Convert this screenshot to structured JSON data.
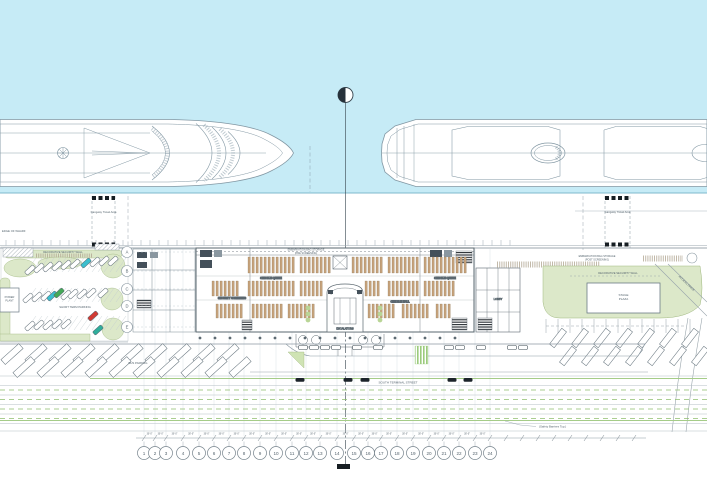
{
  "drawing": {
    "water_color": "#c6ebf6",
    "water_edge_color": "#7fb9cc",
    "landscape_color": "#dce8c9",
    "landscape_edge_color": "#9fb87f",
    "queue_color": "#c5a27b",
    "lane_color": "#8fbf6f",
    "car_accent_colors": [
      "#3bbfce",
      "#44a957",
      "#d23a33",
      "#2fae9b"
    ]
  },
  "labels": {
    "edge_of_wharf": "EDGE OF WHARF",
    "gangway": "Gangway Travel Area",
    "security_wall_left": "DECORATIVE SECURITY WALL",
    "security_wall_right": "DECORATIVE SECURITY WALL",
    "storage_pre_1": "EMBARKATION BAG STORAGE",
    "storage_pre_2": "(PRE SCREENING)",
    "storage_post_1": "EMBARKATION BAG STORAGE",
    "storage_post_2": "(POST SCREENING)",
    "short_term_parking": "SHORT TERM PARKING",
    "bus_parking": "BUS PARKING",
    "street": "SOUTH TERMINAL STREET",
    "safety_barriers": "(Safety Barriers Typ.)",
    "access_drive": "ACCESS DRIVE",
    "plaza_left_1": "POWER",
    "plaza_left_2": "PLANT",
    "plaza_right_1": "STAGE",
    "plaza_right_2": "PLAZA",
    "security_screening": "SECURITY SCREENING",
    "checkin_queue_w": "CHECK-IN QUEUE",
    "checkin_queue_e": "CHECK-IN QUEUE",
    "checkin_hall": "CHECK-IN HALL",
    "escalators": "ESCALATORS",
    "lobby": "LOBBY"
  },
  "dimensions": {
    "module": "30'-0\""
  },
  "grid": {
    "columns": [
      "1",
      "2",
      "3",
      "4",
      "5",
      "6",
      "7",
      "8",
      "9",
      "10",
      "11",
      "12",
      "13",
      "14",
      "15",
      "16",
      "17",
      "18",
      "19",
      "20",
      "21",
      "22",
      "23",
      "24"
    ],
    "rows": [
      "A",
      "B",
      "C",
      "D",
      "E"
    ]
  }
}
